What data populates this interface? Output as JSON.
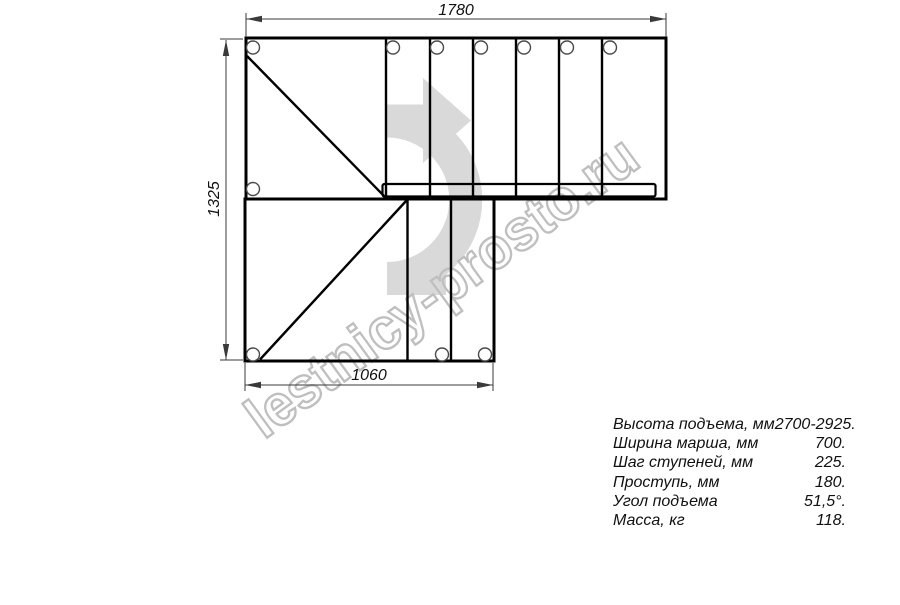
{
  "drawing": {
    "title_hint": "",
    "dimensions": {
      "top": "1780",
      "left": "1325",
      "bottom": "1060"
    },
    "watermark": "lestnicy-prosto.ru",
    "colors": {
      "background": "#ffffff",
      "plan_line": "#000000",
      "dimension_line": "#3a3a3a",
      "arrow_fill": "#d9d9d9",
      "watermark_stroke": "#bfbfbf"
    }
  },
  "specs": {
    "rows": [
      {
        "label": "Высота подъема, мм",
        "value": "2700-2925."
      },
      {
        "label": "Ширина марша, мм",
        "value": "700."
      },
      {
        "label": "Шаг ступеней, мм",
        "value": "225."
      },
      {
        "label": "Проступь, мм",
        "value": "180."
      },
      {
        "label": "Угол подъема",
        "value": "51,5°."
      },
      {
        "label": "Масса, кг",
        "value": "118."
      }
    ]
  }
}
